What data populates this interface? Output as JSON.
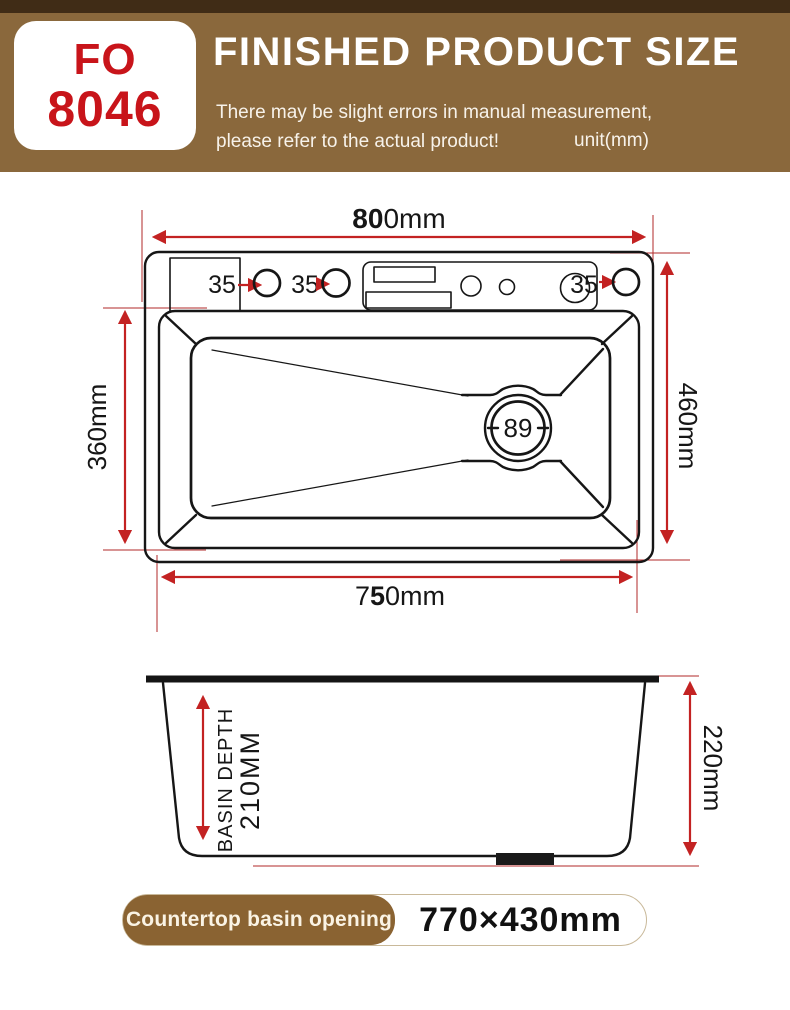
{
  "header": {
    "model_line1": "FO",
    "model_line2": "8046",
    "title": "FINISHED PRODUCT SIZE",
    "subtitle_line1": "There may be slight errors in manual measurement,",
    "subtitle_line2": "please refer to the actual product!",
    "unit": "unit(mm)"
  },
  "colors": {
    "banner_brown": "#8a683c",
    "banner_dark_strip": "#402c16",
    "model_red": "#c8141a",
    "dimension_red": "#c32222",
    "line_black": "#161616",
    "badge_brown": "#8a6332"
  },
  "top_view": {
    "width_label": {
      "bold": "80",
      "rest": "0mm"
    },
    "bottom_label": {
      "pre": "7",
      "bold": "5",
      "rest": "0mm"
    },
    "left_label": "360mm",
    "right_label": "460mm",
    "hole_label_1": "35",
    "hole_label_2": "35",
    "hole_label_3": "35",
    "drain_label": "89"
  },
  "side_view": {
    "depth_label_line1": "BASIN DEPTH",
    "depth_label_line2": "210MM",
    "height_label": "220mm"
  },
  "footer": {
    "opening_label": "Countertop basin opening",
    "opening_size": "770×430mm"
  }
}
